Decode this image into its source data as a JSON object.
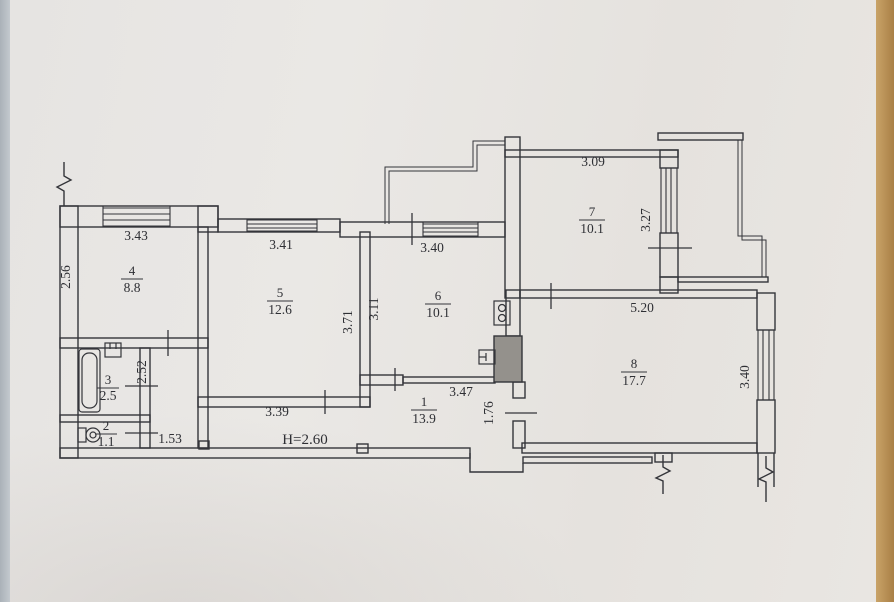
{
  "floorplan": {
    "rooms": {
      "room1": {
        "number": "1",
        "area": "13.9"
      },
      "room2": {
        "number": "2",
        "area": "1.1"
      },
      "room3": {
        "number": "3",
        "area": "2.5"
      },
      "room4": {
        "number": "4",
        "area": "8.8"
      },
      "room5": {
        "number": "5",
        "area": "12.6"
      },
      "room6": {
        "number": "6",
        "area": "10.1"
      },
      "room7": {
        "number": "7",
        "area": "10.1"
      },
      "room8": {
        "number": "8",
        "area": "17.7"
      }
    },
    "dimensions": {
      "room4_width": "3.43",
      "room4_depth": "2.56",
      "room5_width_top": "3.41",
      "room5_width_bottom": "3.39",
      "room5_depth": "3.71",
      "room6_width": "3.40",
      "room6_depth": "3.11",
      "room7_width": "3.09",
      "room7_balcony": "3.27",
      "room8_width": "5.20",
      "room8_window": "3.40",
      "hall_width": "3.47",
      "hall_door_wall": "1.76",
      "bath_depth": "2.52",
      "corridor_width": "1.53",
      "ceiling_height": "H=2.60"
    },
    "colors": {
      "paper": "#e8e5e1",
      "ink": "#34353a",
      "table_edge": "#ab8148",
      "margin": "#bfc5cb"
    }
  }
}
